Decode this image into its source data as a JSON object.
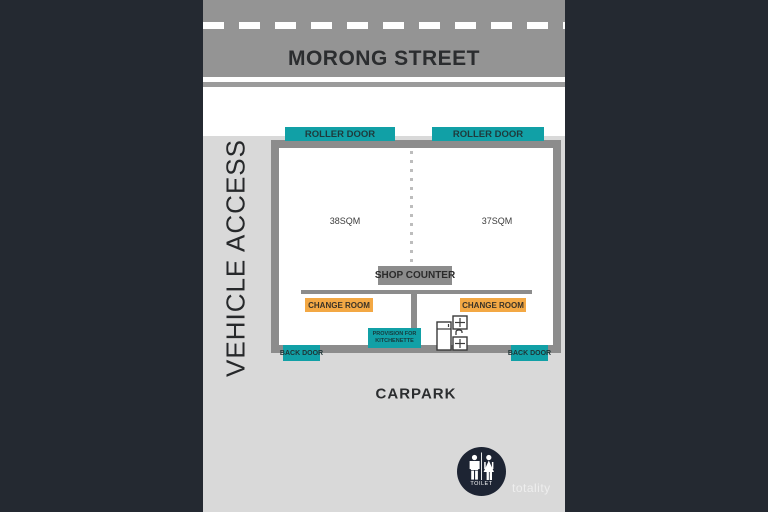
{
  "street": {
    "name": "MORONG STREET"
  },
  "side_labels": {
    "vehicle_access": "VEHICLE ACCESS",
    "carpark": "CARPARK"
  },
  "plan": {
    "roller_door_left": "ROLLER DOOR",
    "roller_door_right": "ROLLER DOOR",
    "room_left_area": "38SQM",
    "room_right_area": "37SQM",
    "shop_counter": "SHOP COUNTER",
    "change_room_left": "CHANGE ROOM",
    "change_room_right": "CHANGE ROOM",
    "kitchenette_line1": "PROVISION FOR",
    "kitchenette_line2": "KITCHENETTE",
    "back_door_left": "BACK DOOR",
    "back_door_right": "BACK DOOR"
  },
  "toilet": {
    "label": "TOILET"
  },
  "watermark": "totality",
  "icons": {
    "toilet_sign": "toilet-sign-icon (man and woman figures)",
    "kitchenette_fixtures": "kitchenette-fixtures-icon (fridge, sink, burners)"
  },
  "colors": {
    "side_panel_dark": "#242931",
    "road_gray": "#949494",
    "background_light": "#d9d9d9",
    "wall_gray": "#8c8c8c",
    "door_teal": "#11a0a6",
    "change_room_orange": "#f3a844",
    "toilet_circle_navy": "#1d2433",
    "text_dark": "#2b2d2f"
  }
}
